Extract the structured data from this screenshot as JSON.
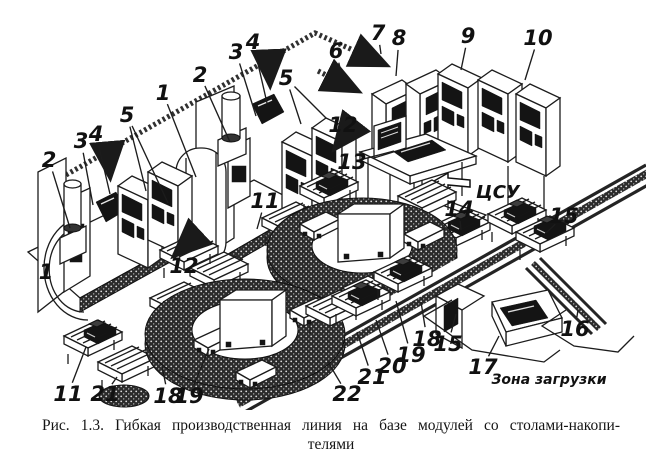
{
  "figure": {
    "type": "technical-illustration",
    "subject": "flexible-production-line-isometric-drawing",
    "caption": {
      "line1": "Рис. 1.3. Гибкая производственная линия на базе модулей со столами-накопи-",
      "line2": "телями"
    },
    "labels": {
      "central_control": "ЦСУ",
      "loading_zone": "Зона загрузки"
    },
    "colors": {
      "ink": "#1c1c1c",
      "paper": "#ffffff",
      "panel": "#141414",
      "texture": "#2b2b2b"
    },
    "callouts": [
      {
        "n": "2",
        "lx": 49,
        "ly": 160,
        "tx": 70,
        "ty": 228
      },
      {
        "n": "3",
        "lx": 81,
        "ly": 141,
        "tx": 93,
        "ty": 205
      },
      {
        "n": "4",
        "lx": 96,
        "ly": 134,
        "tx": 110,
        "ty": 194
      },
      {
        "n": "5",
        "lx": 127,
        "ly": 115,
        "tx": 146,
        "ty": 191,
        "tx2": 168,
        "ty2": 203
      },
      {
        "n": "1",
        "lx": 46,
        "ly": 272
      },
      {
        "n": "12",
        "lx": 184,
        "ly": 266
      },
      {
        "n": "1",
        "lx": 163,
        "ly": 93,
        "tx": 196,
        "ty": 177
      },
      {
        "n": "2",
        "lx": 200,
        "ly": 75,
        "tx": 230,
        "ty": 142
      },
      {
        "n": "3",
        "lx": 236,
        "ly": 52,
        "tx": 256,
        "ty": 116
      },
      {
        "n": "4",
        "lx": 253,
        "ly": 42,
        "tx": 267,
        "ty": 103
      },
      {
        "n": "5",
        "lx": 286,
        "ly": 78,
        "tx": 301,
        "ty": 124,
        "tx2": 326,
        "ty2": 118
      },
      {
        "n": "6",
        "lx": 336,
        "ly": 51,
        "tx": 341,
        "ty": 72
      },
      {
        "n": "7",
        "lx": 378,
        "ly": 33,
        "tx": 381,
        "ty": 54
      },
      {
        "n": "8",
        "lx": 399,
        "ly": 38,
        "tx": 396,
        "ty": 76
      },
      {
        "n": "9",
        "lx": 468,
        "ly": 36,
        "tx": 461,
        "ty": 70
      },
      {
        "n": "10",
        "lx": 538,
        "ly": 38,
        "tx": 525,
        "ty": 80
      },
      {
        "n": "12",
        "lx": 343,
        "ly": 125
      },
      {
        "n": "13",
        "lx": 352,
        "ly": 162,
        "tx": 394,
        "ty": 151
      },
      {
        "n": "11",
        "lx": 265,
        "ly": 201,
        "tx": 257,
        "ty": 229
      },
      {
        "n": "14",
        "lx": 459,
        "ly": 209,
        "tx": 461,
        "ty": 230
      },
      {
        "n": "15",
        "lx": 564,
        "ly": 216,
        "tx": 546,
        "ty": 233
      },
      {
        "n": "11",
        "lx": 68,
        "ly": 394,
        "tx": 86,
        "ty": 347
      },
      {
        "n": "21",
        "lx": 105,
        "ly": 394,
        "tx": 117,
        "ty": 377
      },
      {
        "n": "18",
        "lx": 168,
        "ly": 396,
        "tx": 162,
        "ty": 366
      },
      {
        "n": "19",
        "lx": 189,
        "ly": 396,
        "tx": 209,
        "ty": 349
      },
      {
        "n": "22",
        "lx": 347,
        "ly": 394,
        "tx": 328,
        "ty": 362
      },
      {
        "n": "21",
        "lx": 372,
        "ly": 377,
        "tx": 357,
        "ty": 332
      },
      {
        "n": "20",
        "lx": 392,
        "ly": 366,
        "tx": 376,
        "ty": 320
      },
      {
        "n": "19",
        "lx": 411,
        "ly": 355,
        "tx": 396,
        "ty": 301
      },
      {
        "n": "18",
        "lx": 427,
        "ly": 339,
        "tx": 421,
        "ty": 302
      },
      {
        "n": "15",
        "lx": 448,
        "ly": 344,
        "tx": 456,
        "ty": 314
      },
      {
        "n": "16",
        "lx": 575,
        "ly": 329,
        "tx": 578,
        "ty": 310
      },
      {
        "n": "17",
        "lx": 483,
        "ly": 367,
        "tx": 499,
        "ty": 336
      }
    ]
  }
}
